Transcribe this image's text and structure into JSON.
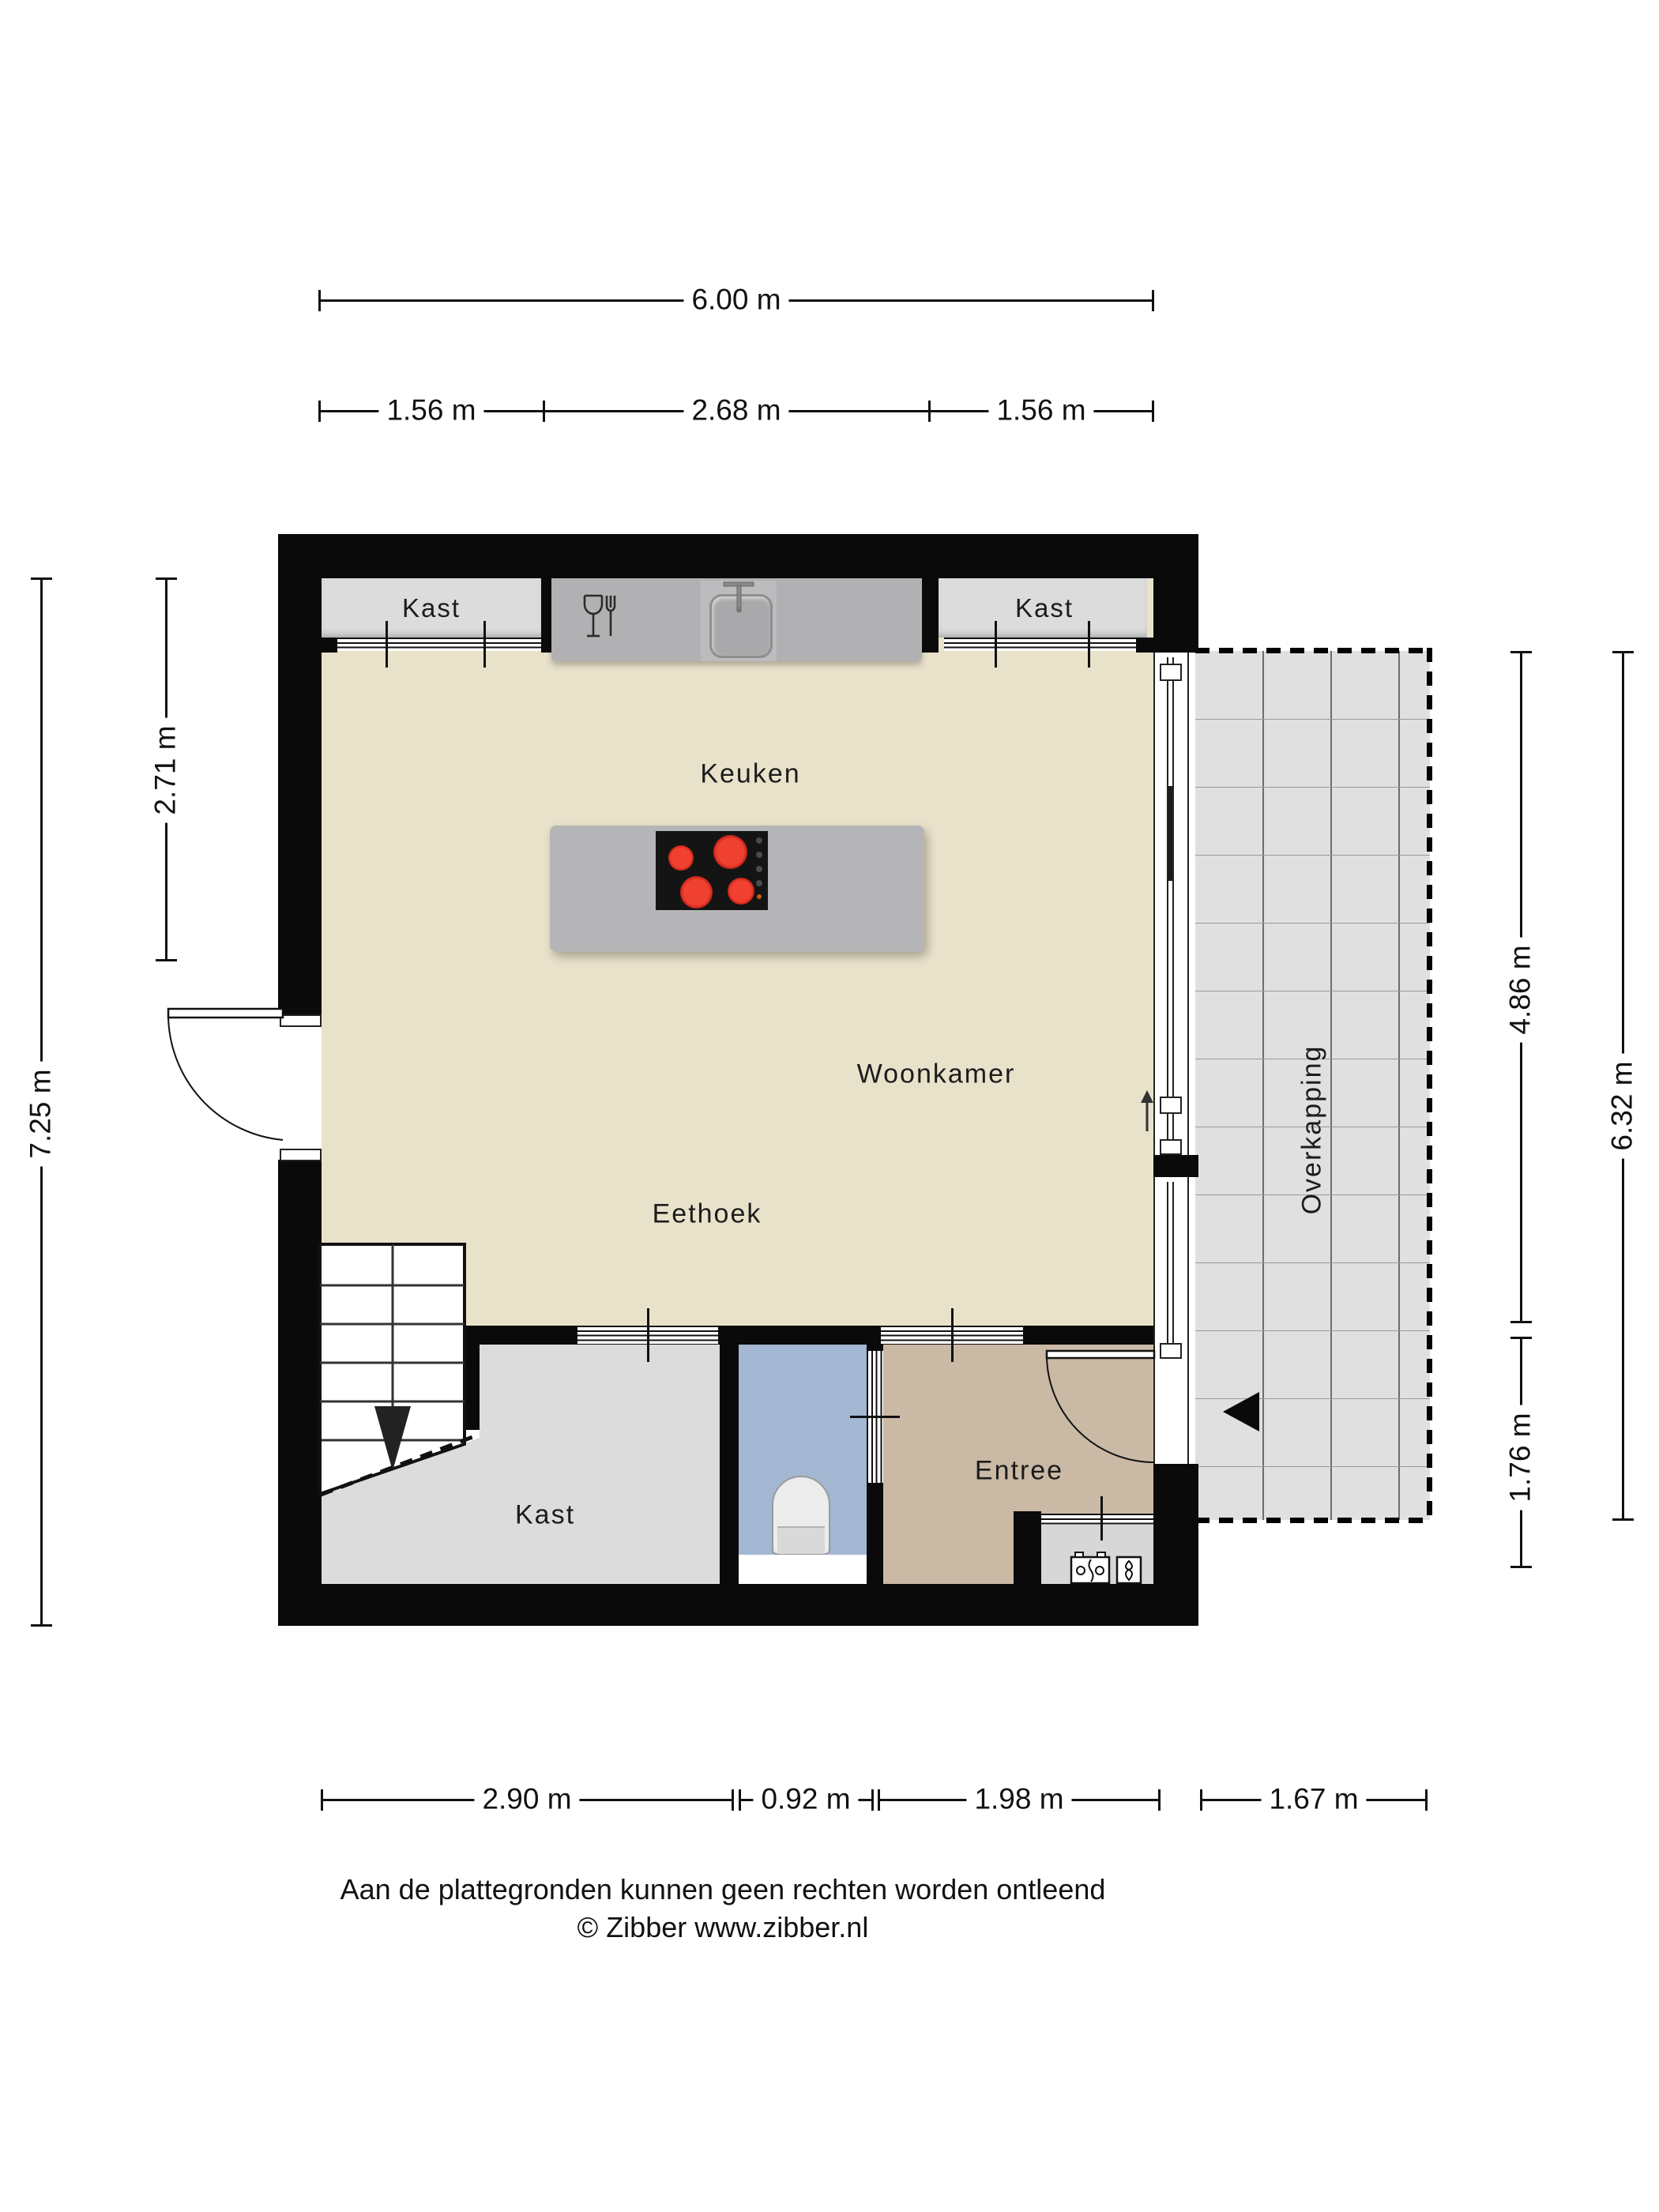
{
  "floorplan": {
    "rooms": {
      "kast_top_left": "Kast",
      "kast_top_right": "Kast",
      "keuken": "Keuken",
      "woonkamer": "Woonkamer",
      "eethoek": "Eethoek",
      "kast_bottom": "Kast",
      "entree": "Entree",
      "overkapping": "Overkapping"
    },
    "dimensions": {
      "top_total": "6.00 m",
      "top_left": "1.56 m",
      "top_mid": "2.68 m",
      "top_right": "1.56 m",
      "left_total": "7.25 m",
      "left_inner": "2.71 m",
      "right_upper": "4.86 m",
      "right_lower": "1.76 m",
      "right_total": "6.32 m",
      "bottom_1": "2.90 m",
      "bottom_2": "0.92 m",
      "bottom_3": "1.98 m",
      "bottom_4": "1.67 m"
    },
    "footer": {
      "line1": "Aan de plattegronden kunnen geen rechten worden ontleend",
      "line2": "© Zibber www.zibber.nl"
    },
    "colors": {
      "wall": "#0a0a0a",
      "floor_living": "#e9e2cb",
      "closet_gray": "#dcdcdc",
      "counter_gray": "#b1b1b3",
      "island_gray": "#b5b5b7",
      "wc_blue": "#a3b7d2",
      "entree_tan": "#cab9a5",
      "terrace_gray": "#e0e0e0",
      "burner_red": "#d92f20"
    },
    "icons": {
      "cooktop": "cooktop-icon",
      "sink": "sink-icon",
      "dishwasher": "glass-fork-icon",
      "toilet": "toilet-icon",
      "electric_meter": "electric-meter-icon",
      "gas_meter": "gas-meter-icon",
      "stairs_arrow": "stairs-down-arrow-icon",
      "slide_arrow": "door-slide-arrow-icon",
      "entrance_arrow": "entrance-arrow-icon"
    }
  }
}
